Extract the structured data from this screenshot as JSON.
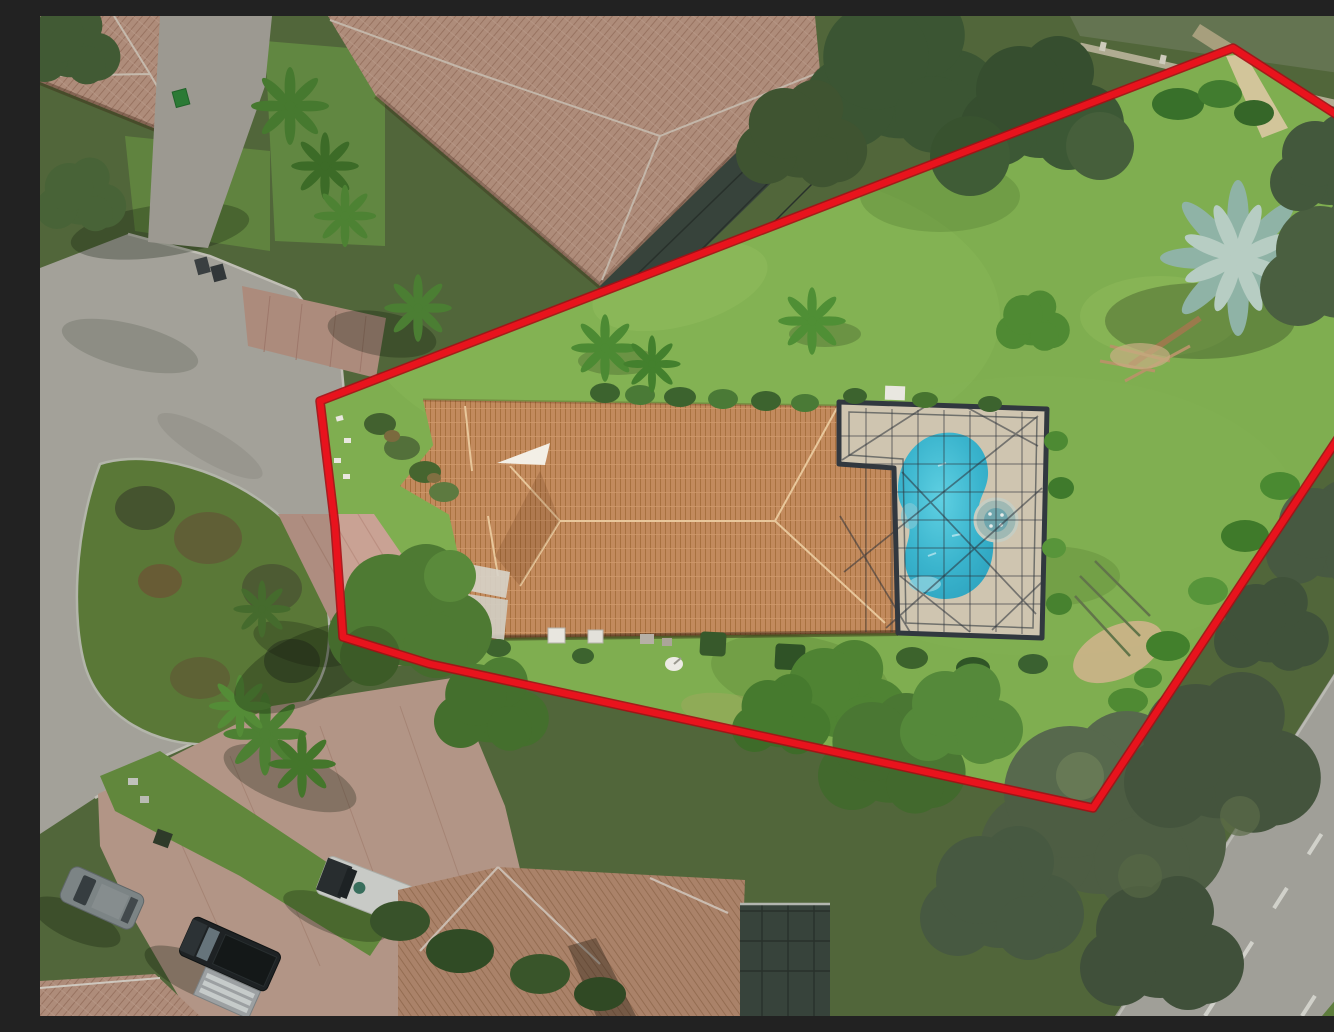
{
  "scene": {
    "image_type": "aerial-drone-photo",
    "description": "Overhead aerial photograph of a single-family Florida home on a pie-shaped lot outlined with a red property-boundary line. The lot contains a long terracotta tile-roof house, a screened pool enclosure with a freeform turquoise pool and round spa, a large grassy backyard with palms and a silver Bismarck palm, bordered by a cul-de-sac street on the left and a tree-lined perimeter road at lower right. Neighboring tile-roof homes, paver driveways and parked vehicles surround the lot.",
    "colors": {
      "boundary": "#e8131d",
      "boundary_outline": "#a60e14",
      "lawn": "#7fae50",
      "lawn_outside": "#5c7442",
      "street": "#bcb9b2",
      "island": "#67893f",
      "pavers": "#c9a294",
      "apron_pavers": "#c79f90",
      "court_pavers": "#ceab9c",
      "roof_main_base": "#c28a5d",
      "roof_main_line": "#a8713f",
      "roof_neighbor_base": "#c9a08d",
      "roof_neighbor_line": "#b08370",
      "roof_bottom_base": "#c59479",
      "roof_bottom_line": "#ab7c5e",
      "pool_deck": "#cfc5b0",
      "pool_water_center": "#5fd0e2",
      "pool_water_edge": "#2da3bf",
      "spa": "#9fb9b4",
      "cage_frame": "#31383f",
      "lanai_screen": "#3e4a44",
      "road": "#b9b7b1",
      "lane_marking": "#f2f1ec",
      "sand_path": "#d7c69e",
      "dirt_patch": "#cdb489",
      "silver_palm": "#b7cdc3",
      "pine_canopy": "#57694d",
      "tree_canopy": "#4e7a33",
      "hedge_dark": "#3c632e",
      "shadow": "rgba(15,25,10,0.3)"
    },
    "elements": [
      "property-boundary",
      "main-house-roof",
      "pool-screen-enclosure",
      "swimming-pool",
      "spa",
      "pool-deck",
      "backyard-lawn",
      "silver-palm-tree",
      "small-palm-trees",
      "garden-hedges",
      "cul-de-sac-street",
      "landscaped-median-island",
      "driveway-pavers",
      "front-walkway",
      "ac-units",
      "satellite-dish",
      "neighbor-house-roof-northwest",
      "neighbor-house-roof-north",
      "neighbor-lanai-north",
      "neighbor-house-roof-south",
      "neighbor-lanai-south",
      "motor-court",
      "suv-gray",
      "pickup-truck-black",
      "pickup-truck-white",
      "utility-trailer",
      "trash-bins",
      "perimeter-road",
      "lane-markings",
      "pine-canopy",
      "sand-path",
      "dirt-patch",
      "tree-shadows",
      "boundary-wall"
    ],
    "counts": {
      "vehicles_visible": 4,
      "pools": 1,
      "spas": 1
    }
  }
}
